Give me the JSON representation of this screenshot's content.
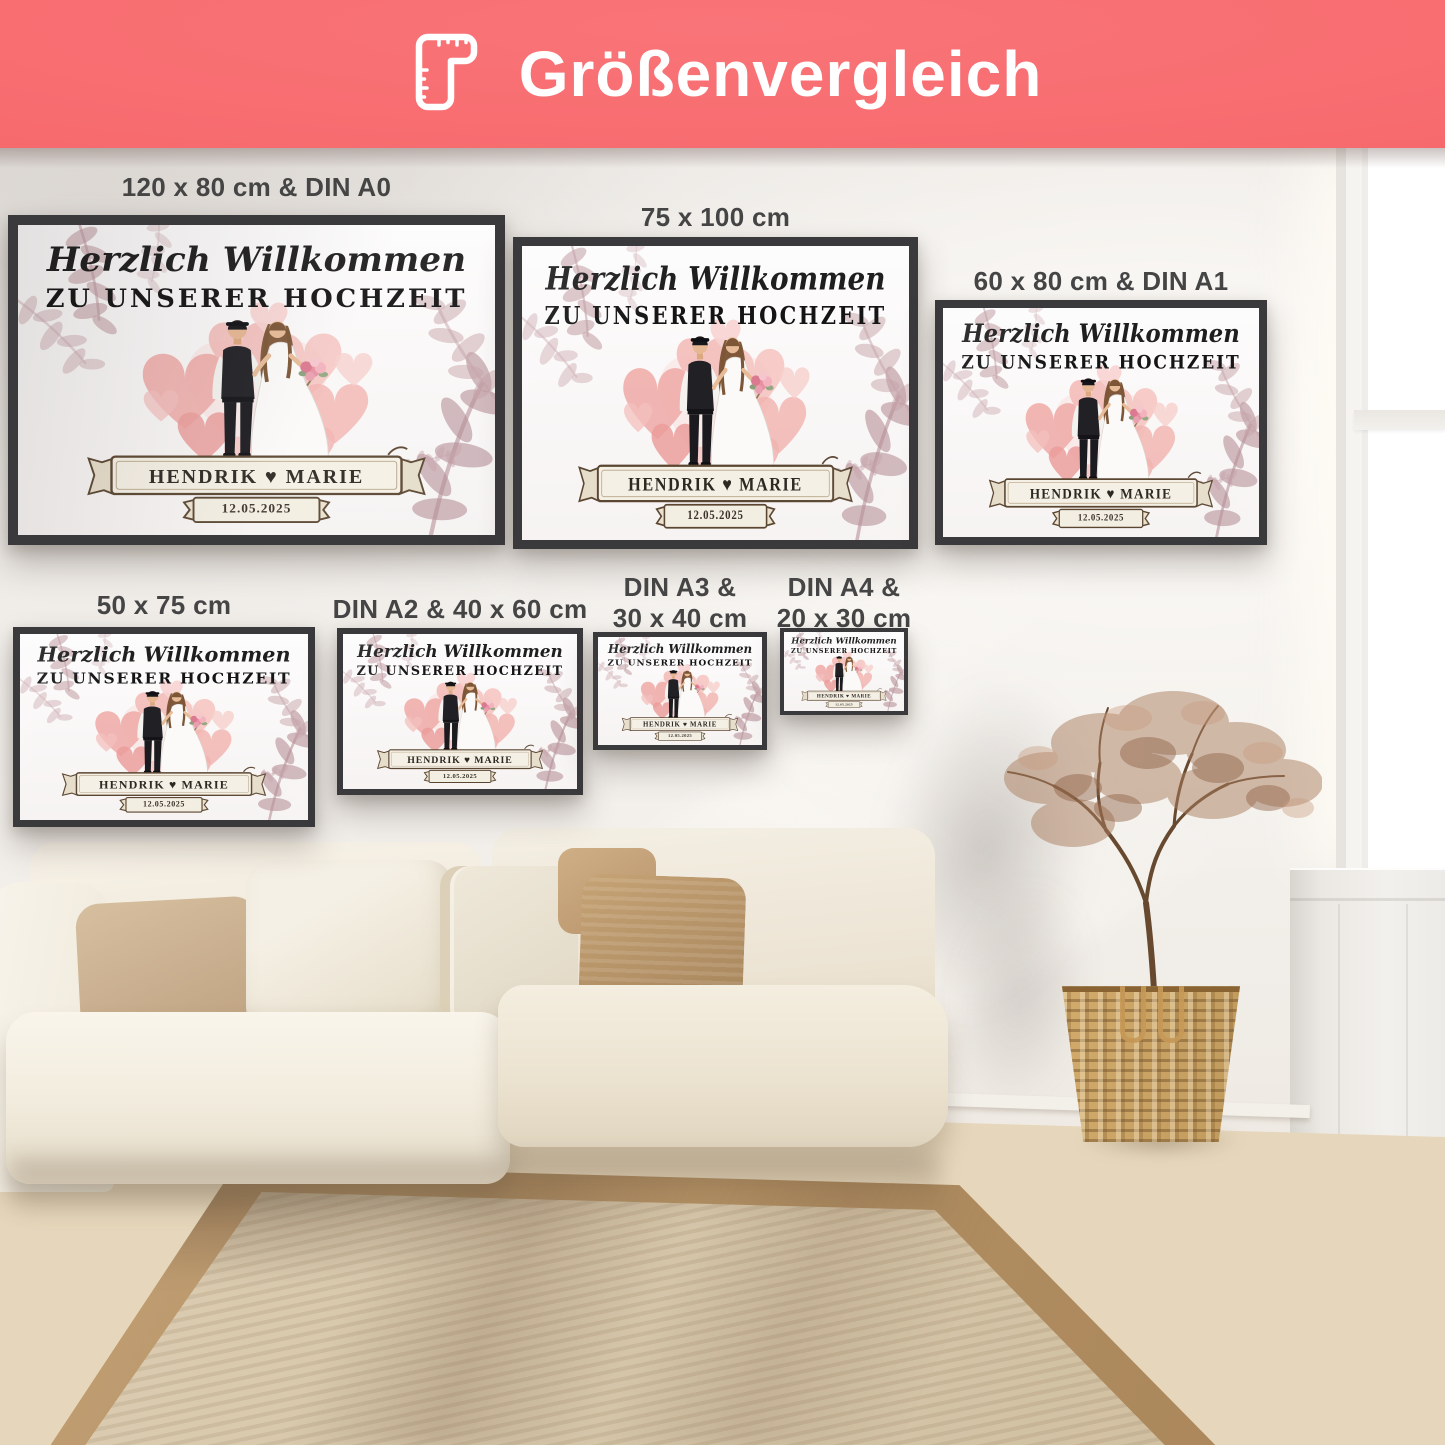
{
  "header": {
    "title": "Größenvergleich"
  },
  "poster_design": {
    "script_title": "Herzlich Willkommen",
    "main_title": "ZU UNSERER HOCHZEIT",
    "names": "HENDRIK ♥ MARIE",
    "date": "12.05.2025"
  },
  "posters": [
    {
      "id": "120x80-din-a0",
      "label_lines": [
        "120 x 80 cm & DIN A0"
      ]
    },
    {
      "id": "75x100",
      "label_lines": [
        "75 x 100 cm"
      ]
    },
    {
      "id": "60x80-din-a1",
      "label_lines": [
        "60 x 80 cm & DIN A1"
      ]
    },
    {
      "id": "50x75",
      "label_lines": [
        "50 x 75 cm"
      ]
    },
    {
      "id": "din-a2-40x60",
      "label_lines": [
        "DIN A2 & 40 x 60 cm"
      ]
    },
    {
      "id": "din-a3-30x40",
      "label_lines": [
        "DIN A3 &",
        "30 x 40 cm"
      ]
    },
    {
      "id": "din-a4-20x30",
      "label_lines": [
        "DIN A4 &",
        "20 x 30 cm"
      ]
    }
  ],
  "colors": {
    "header_background": "#f76b6e",
    "header_text": "#ffffff",
    "frame": "#3a393c",
    "label_text": "#454545",
    "heart_pink": "#f0adaa",
    "leaf_mauve": "#c2a0a6",
    "banner_outline": "#5a4631"
  }
}
